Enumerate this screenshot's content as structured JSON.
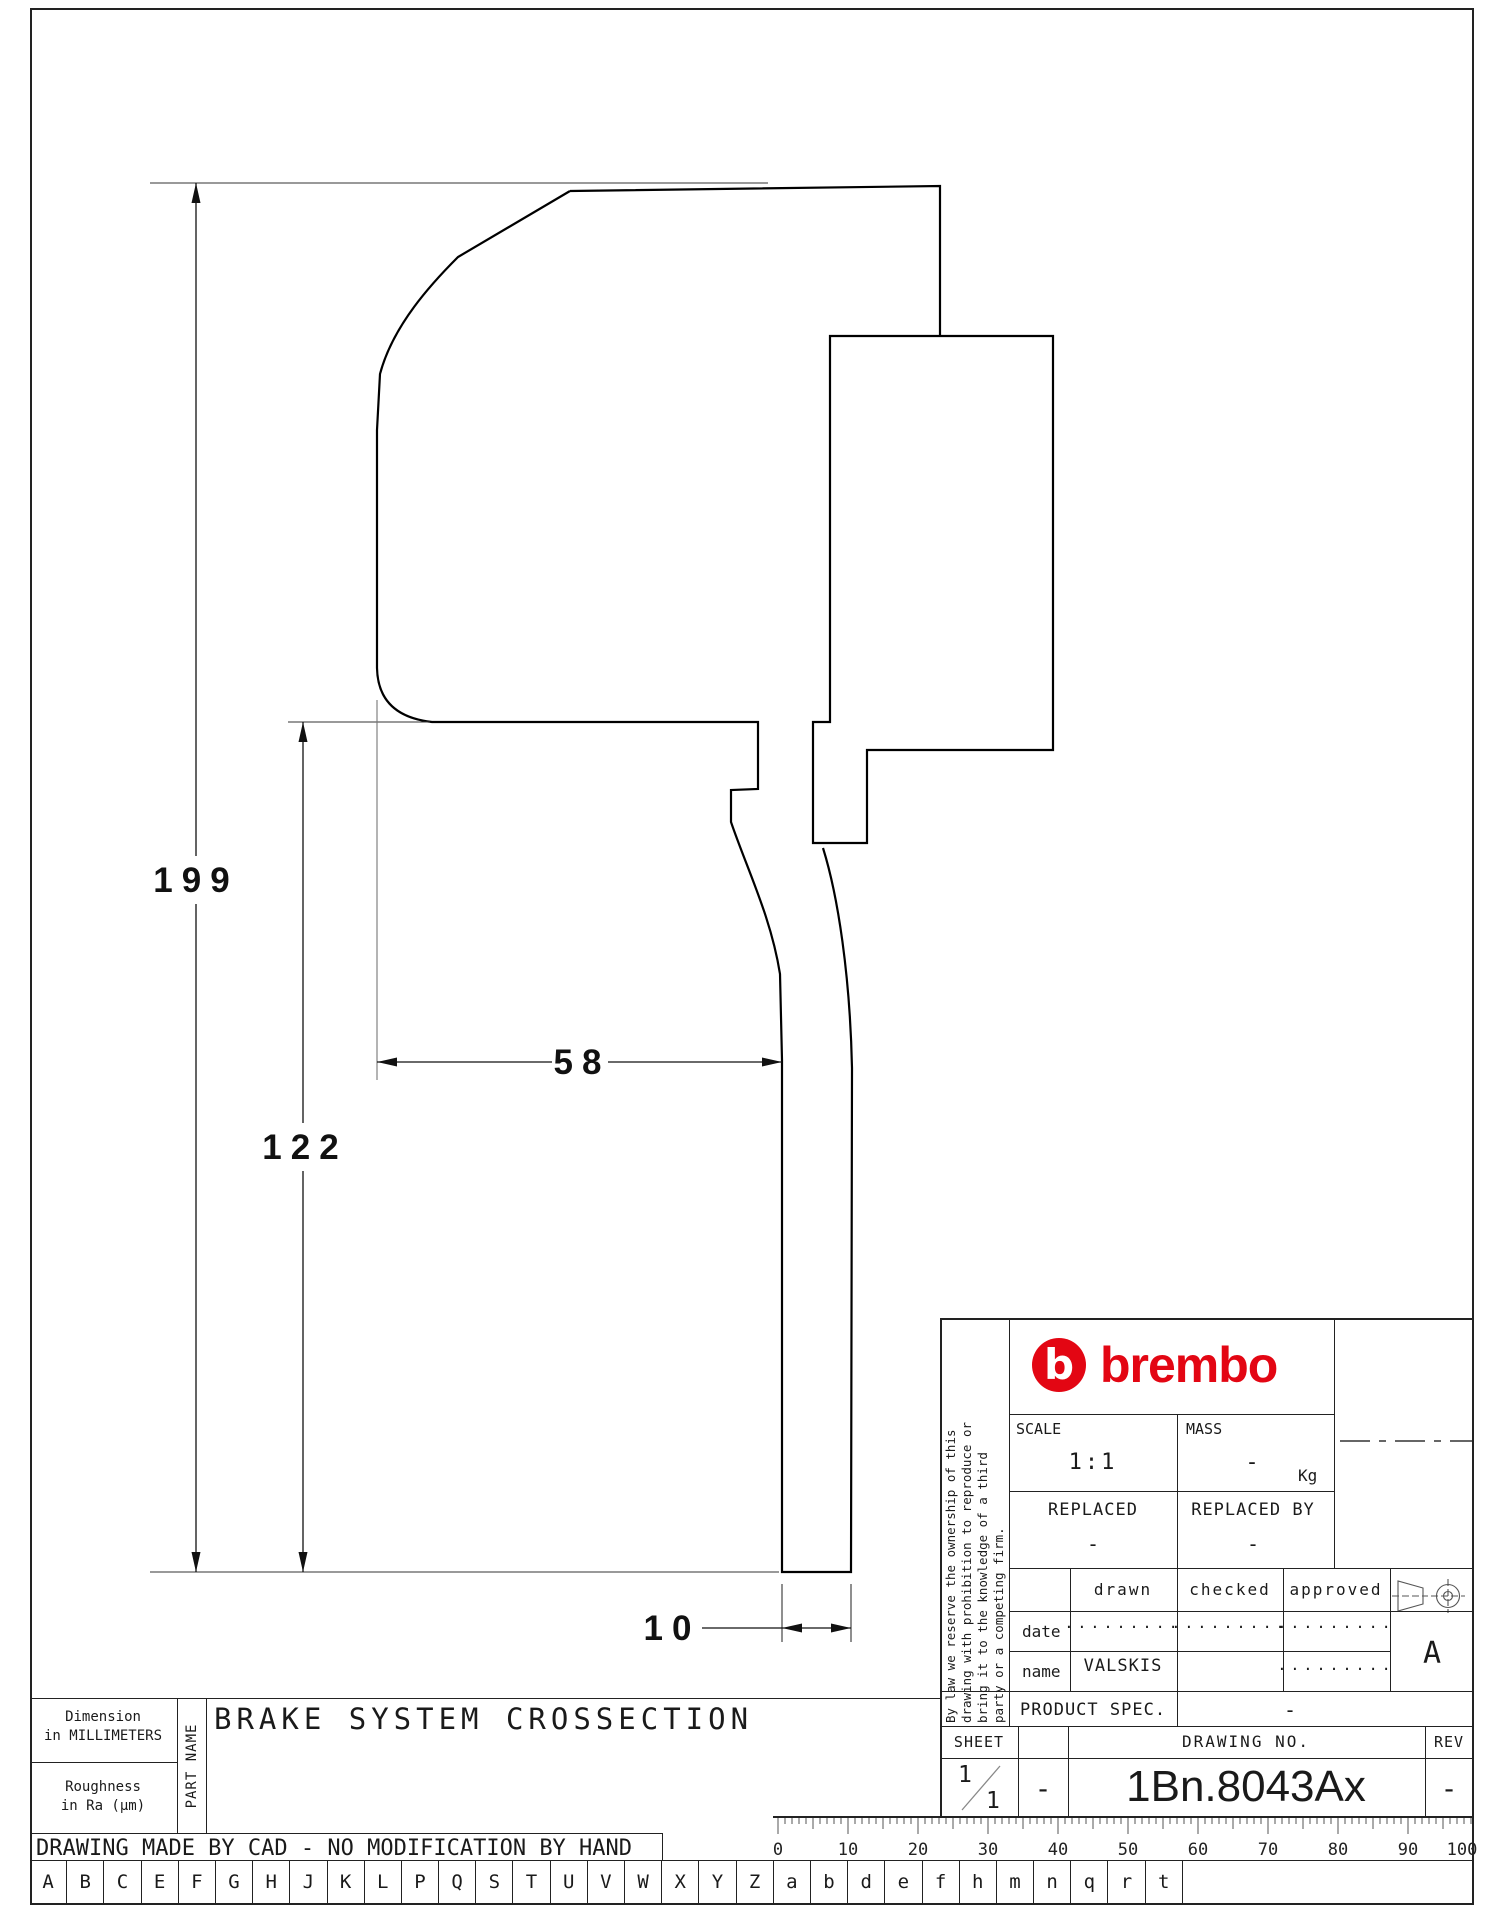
{
  "accent_red": "#e30613",
  "drawing": {
    "dim_total_height": "199",
    "dim_lower_height": "122",
    "dim_body_width": "58",
    "dim_stem_width": "10"
  },
  "title_block": {
    "brand": "brembo",
    "disclaimer_lines": [
      "By law we reserve the ownership of this",
      "drawing with prohibition to reproduce or",
      "bring it to the knowledge of a third",
      "party or a competing firm."
    ],
    "scale_label": "SCALE",
    "scale_value": "1:1",
    "mass_label": "MASS",
    "mass_value": "-",
    "mass_unit": "Kg",
    "replaced_label": "REPLACED",
    "replaced_value": "-",
    "replaced_by_label": "REPLACED BY",
    "replaced_by_value": "-",
    "table": {
      "col_drawn": "drawn",
      "col_checked": "checked",
      "col_approved": "approved",
      "row_date_label": "date",
      "row_name_label": "name",
      "date_drawn": ".........",
      "date_checked": ".........",
      "date_approved": ".........",
      "name_drawn": "VALSKIS",
      "name_checked": "",
      "name_approved": "........."
    },
    "product_spec_label": "PRODUCT SPEC.",
    "product_spec_value": "-",
    "sheet_label": "SHEET",
    "sheet_num": "1",
    "sheet_total": "1",
    "sheet_dash": "-",
    "drawing_no_label": "DRAWING NO.",
    "drawing_no": "1Bn.8043Ax",
    "rev_label": "REV",
    "rev_value": "-",
    "revision_letter": "A"
  },
  "footer": {
    "dimension_note": [
      "Dimension",
      "in MILLIMETERS"
    ],
    "roughness_note": [
      "Roughness",
      "in Ra (µm)"
    ],
    "part_name_label": "PART NAME",
    "part_title": "BRAKE SYSTEM CROSSECTION",
    "cad_note": "DRAWING MADE BY CAD - NO MODIFICATION BY HAND",
    "ruler_numbers": [
      "0",
      "10",
      "20",
      "30",
      "40",
      "50",
      "60",
      "70",
      "80",
      "90",
      "100"
    ],
    "letters": [
      "A",
      "B",
      "C",
      "E",
      "F",
      "G",
      "H",
      "J",
      "K",
      "L",
      "P",
      "Q",
      "S",
      "T",
      "U",
      "V",
      "W",
      "X",
      "Y",
      "Z",
      "a",
      "b",
      "d",
      "e",
      "f",
      "h",
      "m",
      "n",
      "q",
      "r",
      "t"
    ]
  }
}
